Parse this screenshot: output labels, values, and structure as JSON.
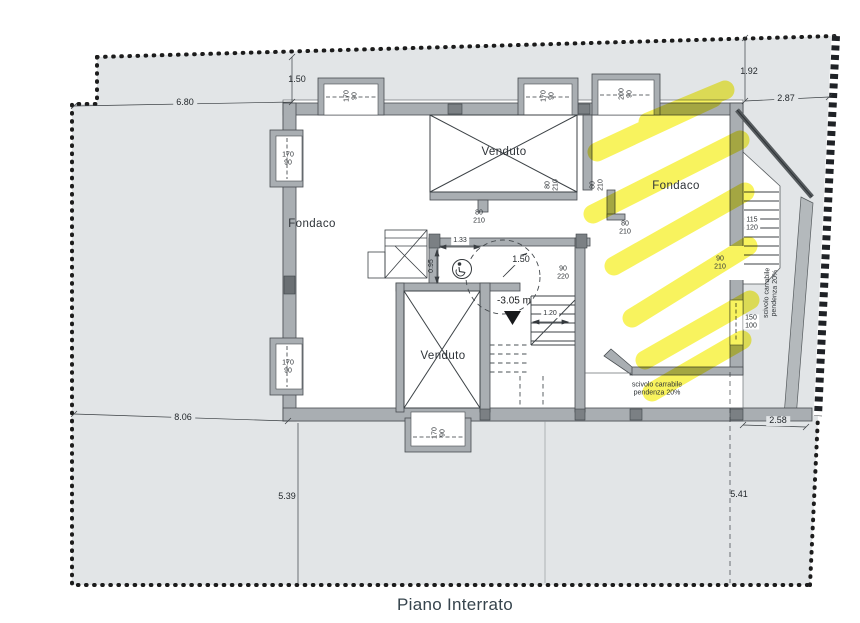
{
  "title": "Piano Interrato",
  "rooms": {
    "fondaco_left": "Fondaco",
    "fondaco_right": "Fondaco",
    "venduto_top": "Venduto",
    "venduto_bottom": "Venduto"
  },
  "dimensions": {
    "plot_top_gap": "1.50",
    "plot_left_top": "6.80",
    "plot_right_gap_v": "1.92",
    "plot_right_gap_h": "2.87",
    "plot_left_bottom": "8.06",
    "plot_bottom_left": "5.39",
    "plot_bottom_right": "5.41",
    "plot_bottom_right_h": "2.58",
    "lobby_width": "1.33",
    "lobby_depth": "0.95",
    "turning_radius": "1.50",
    "stair_width": "1.20",
    "floor_level": "-3.05 m"
  },
  "openings": {
    "window_top_1": {
      "w": "170",
      "h": "90"
    },
    "window_top_2": {
      "w": "170",
      "h": "90"
    },
    "window_top_3": {
      "w": "200",
      "h": "90"
    },
    "window_left_upper": {
      "w": "170",
      "h": "90"
    },
    "window_left_lower": {
      "w": "170",
      "h": "90"
    },
    "window_bottom": {
      "w": "170",
      "h": "90"
    },
    "window_right": {
      "w": "150",
      "h": "100"
    },
    "door_venduto_bottom": {
      "w": "80",
      "h": "210"
    },
    "door_venduto_right": {
      "w": "80",
      "h": "210"
    },
    "door_fondaco_left": {
      "w": "80",
      "h": "210"
    },
    "door_fondaco_inner": {
      "w": "80",
      "h": "210"
    },
    "door_lobby_right": {
      "w": "90",
      "h": "220"
    },
    "door_external": {
      "w": "90",
      "h": "210"
    },
    "external_stair": {
      "w": "115",
      "h": "120"
    }
  },
  "ramp": {
    "line1": "scivolo carrabile",
    "line2": "pendenza 20%"
  },
  "colors": {
    "terrain": "#e2e5e7",
    "wall": "#a9aeb2",
    "wall_dark": "#474c50",
    "highlight_yellow": "#f7f13a",
    "line": "#3a3f43",
    "text": "#2a2f33",
    "paper": "#ffffff"
  }
}
